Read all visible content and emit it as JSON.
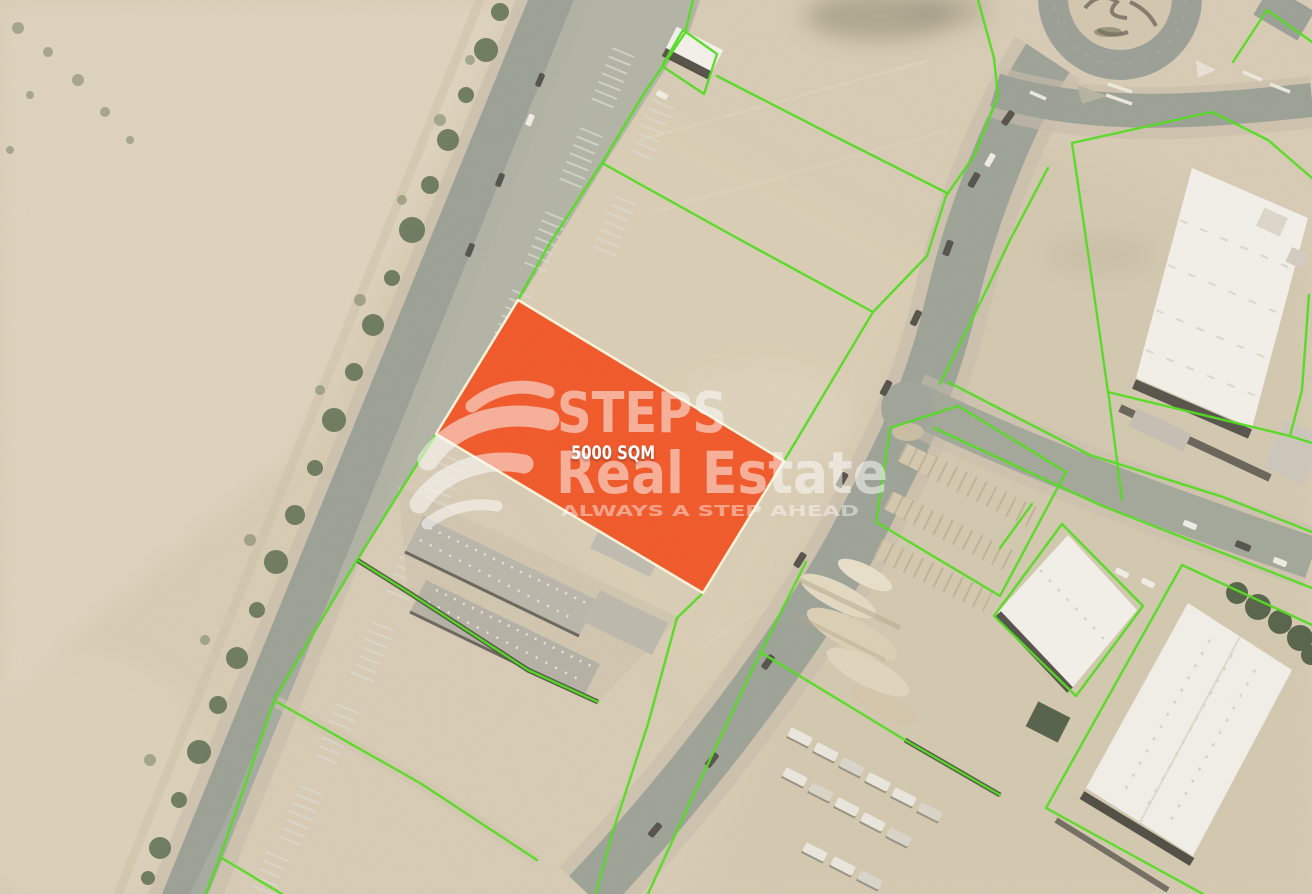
{
  "map": {
    "colors": {
      "parcel_line": "#53DD20",
      "plot_fill": "#F1592A",
      "plot_border": "#FBF5DC",
      "sand": "#D8CCB5",
      "road": "#9CA196",
      "trees": "#5C6E51",
      "roof_white": "#F2F0E9",
      "roof_grey": "#B9B5AA",
      "watermark": "#FFFFFF"
    },
    "plot": {
      "area_label": "5000 SQM"
    },
    "watermark": {
      "brand": "STEPS",
      "brand_line2": "Real Estate",
      "tagline": "ALWAYS A STEP AHEAD"
    }
  }
}
